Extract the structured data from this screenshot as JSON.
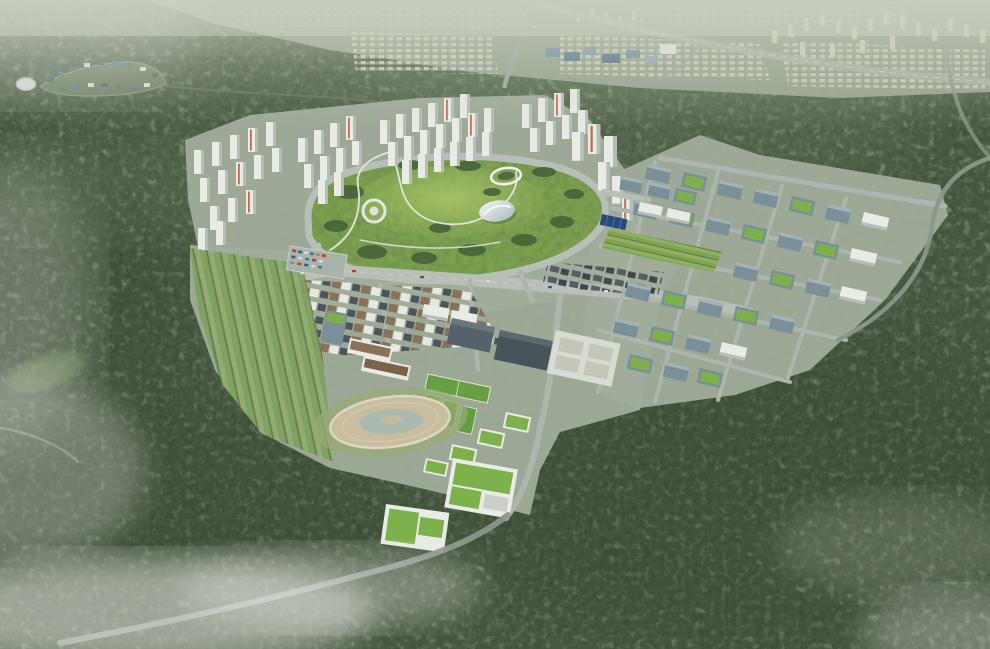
{
  "meta": {
    "kind": "architectural aerial rendering",
    "aria_label": "Bird's-eye architectural rendering of a planned eco-city district in a forested valley, with white apartment towers, a central hilltop park, office campus blocks with green roofs, and an existing hazy city on the horizon"
  },
  "palette": {
    "forest": "#44523c",
    "forestDk": "#2c3927",
    "forestLt": "#8ea47c",
    "haze": "#c8d1c0",
    "ground": "#a1ad9b",
    "road": "#b8bfb6",
    "roadMinor": "#adb6ac",
    "roadDk": "#8b978a",
    "path": "#e0e4dc",
    "park": "#7da24e",
    "parkLt": "#a9c168",
    "tree": "#47633a",
    "bw": "#e9ebe5",
    "bs": "#b4bdb8",
    "accent": "#bf6c4d",
    "glass": "#7b8f99",
    "glassLt": "#a5b2b7",
    "glassDk": "#5a6b74",
    "groof": "#7db14c",
    "sand": "#c8bd9f",
    "water": "#a9b9b0",
    "court": "#619e40",
    "field": "#66a041",
    "terrA": "#92ac71",
    "terrB": "#80a061",
    "terrLine": "#667f4b",
    "town": "#4d555a",
    "townBrown": "#8a7258",
    "city": "#cfcdbc",
    "cityShade": "#a2a795",
    "cityGround": "#9aa592",
    "indBlue": "#6c86a0",
    "indBlueDk": "#52708a",
    "solar": "#2a4a7d",
    "metal": "#cdd3d6",
    "metalHi": "#f2f5f4",
    "mist": "#e6ebe4",
    "parking": "#a9b2ab"
  },
  "features": {
    "scene": "Aerial bird's-eye rendering of a planned green city district surrounded by forested hills",
    "forest": "Dense forested hills surrounding the development site",
    "distant_city": "Hazy existing city, apartment blocks and highway on the horizon",
    "hillside_village": "Small hillside housing cluster with a round community building",
    "apartment_towers": "Clusters of white high-rise apartment towers",
    "central_park": "Central hilltop park with lawns, tree groves and winding trails",
    "landmark_building": "Curved silver landmark pavilion at the foot of the park hill",
    "ring_pavilion": "Oval ring pavilion on the park hilltop",
    "circular_plaza": "Circular plaza structure on the park's west slope",
    "business_district": "Mid-rise office campus with glass blocks and planted green roofs",
    "allotment_gardens": "Striped community garden plots",
    "boulevard": "Main tree-lined boulevard with traffic",
    "townhouse_district": "Rows of low-rise townhouses",
    "terraced_fields": "Terraced green fields stepping down the western slope",
    "retention_pond": "Sandy retention pond and wetland ring",
    "sports_fields": "Playing field and green sports courts",
    "green_roof_complex": "Stepped research buildings with planted green roofs",
    "valley_road": "Access road descending through the forest valley",
    "mist": "Low clouds drifting over the forest"
  }
}
